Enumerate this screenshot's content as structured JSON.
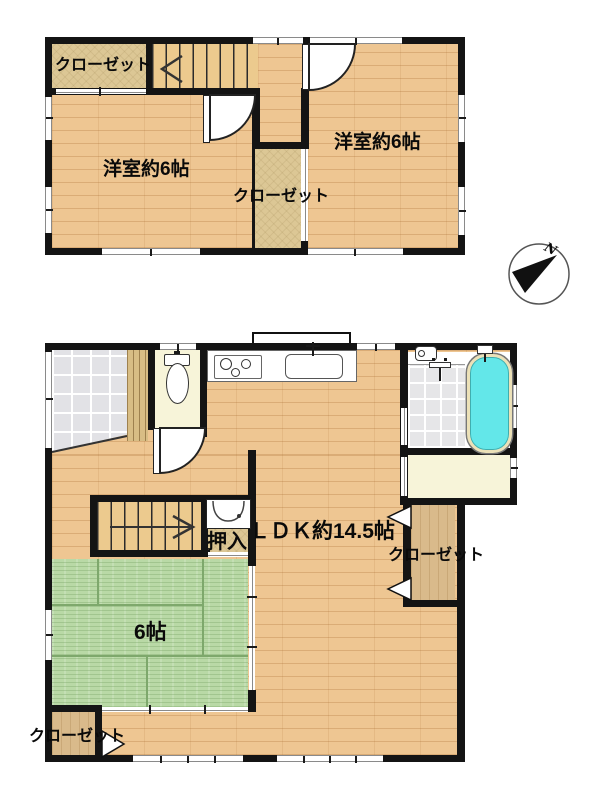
{
  "compass": {
    "north_label": "N"
  },
  "floor2": {
    "closet_top_left": "クローゼット",
    "room_left": "洋室約6帖",
    "room_right": "洋室約6帖",
    "closet_middle": "クローゼット"
  },
  "floor1": {
    "ldk": "ＬＤＫ約14.5帖",
    "closet_right": "クローゼット",
    "oshiire": "押入",
    "tatami": "6帖",
    "closet_bottom_left": "クローゼット"
  },
  "icons": {
    "stairs_arrow_2f": "chevron-left",
    "stairs_arrow_1f": "arrow-right",
    "compass_needle": "northeast-wedge",
    "fixtures": [
      "toilet",
      "kitchen-stove",
      "kitchen-sink",
      "washbasin",
      "bathtub",
      "shower-faucet",
      "washer-pan",
      "door-swing-arc"
    ]
  },
  "colors": {
    "wall": "#141414",
    "wood_floor": "#eec692",
    "tatami_green": "#b9d9a6",
    "closet_tan": "#dcc795",
    "closet_wood": "#d9ba8b",
    "stairs": "#ecca8e",
    "entry_tile": "#e2e2e6",
    "room_cream": "#f7f4d9",
    "bathtub_cyan": "#63e7e9",
    "bathtub_rim": "#ece1b8"
  }
}
